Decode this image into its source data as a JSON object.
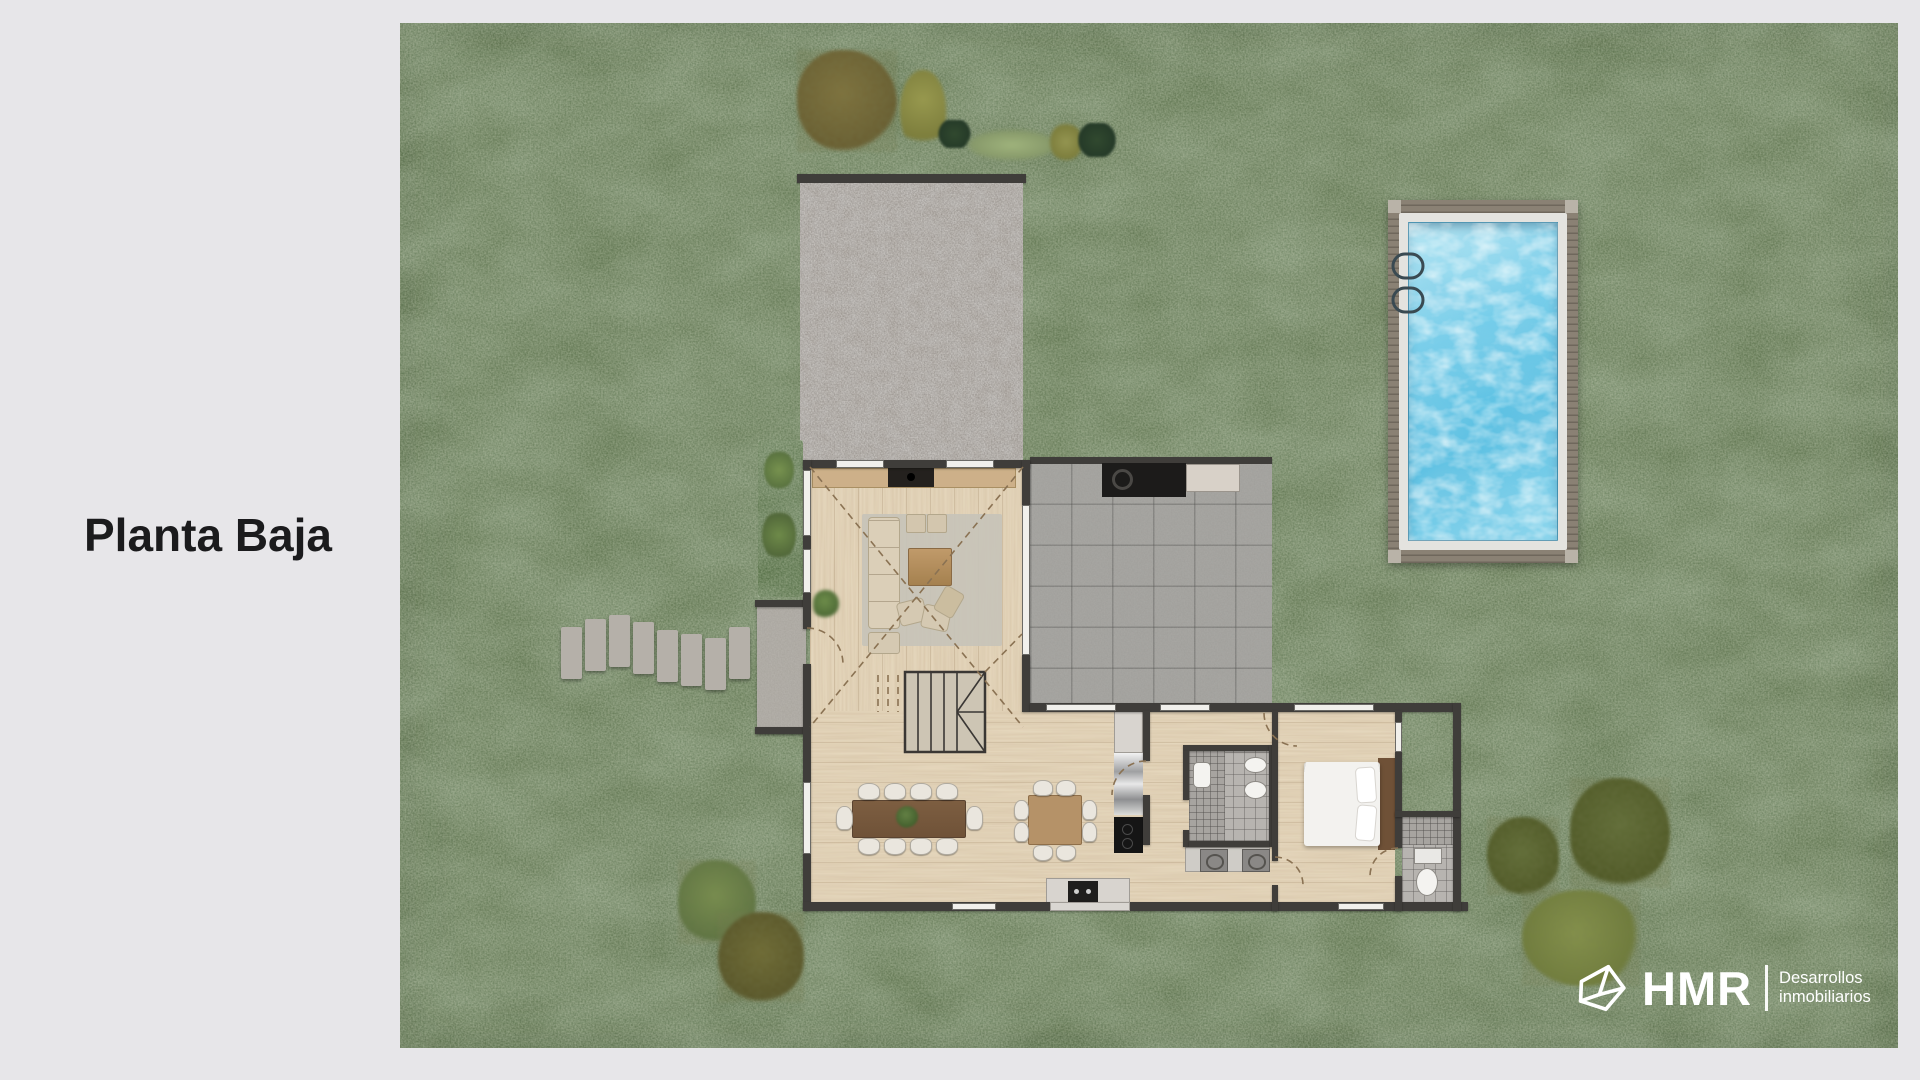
{
  "page": {
    "background": "#e7e6e9"
  },
  "title": "Planta Baja",
  "brand": {
    "name": "HMR",
    "tagline_line1": "Desarrollos",
    "tagline_line2": "inmobiliarios",
    "mark": "hmr-origami-mark-icon",
    "text_color": "#ffffff"
  },
  "palette": {
    "grass": "#5e744f",
    "gravel": "#928c85",
    "stone_tile_terrace": "#a09f9b",
    "wood_floor": "#e6d8be",
    "walls": "#3f3d3a",
    "pool_water": "#63c6e6",
    "pool_deck": "#8a8174",
    "pool_coping": "#e4e3df",
    "rug": "#c7c3b9",
    "title_color": "#1b1b1d"
  }
}
